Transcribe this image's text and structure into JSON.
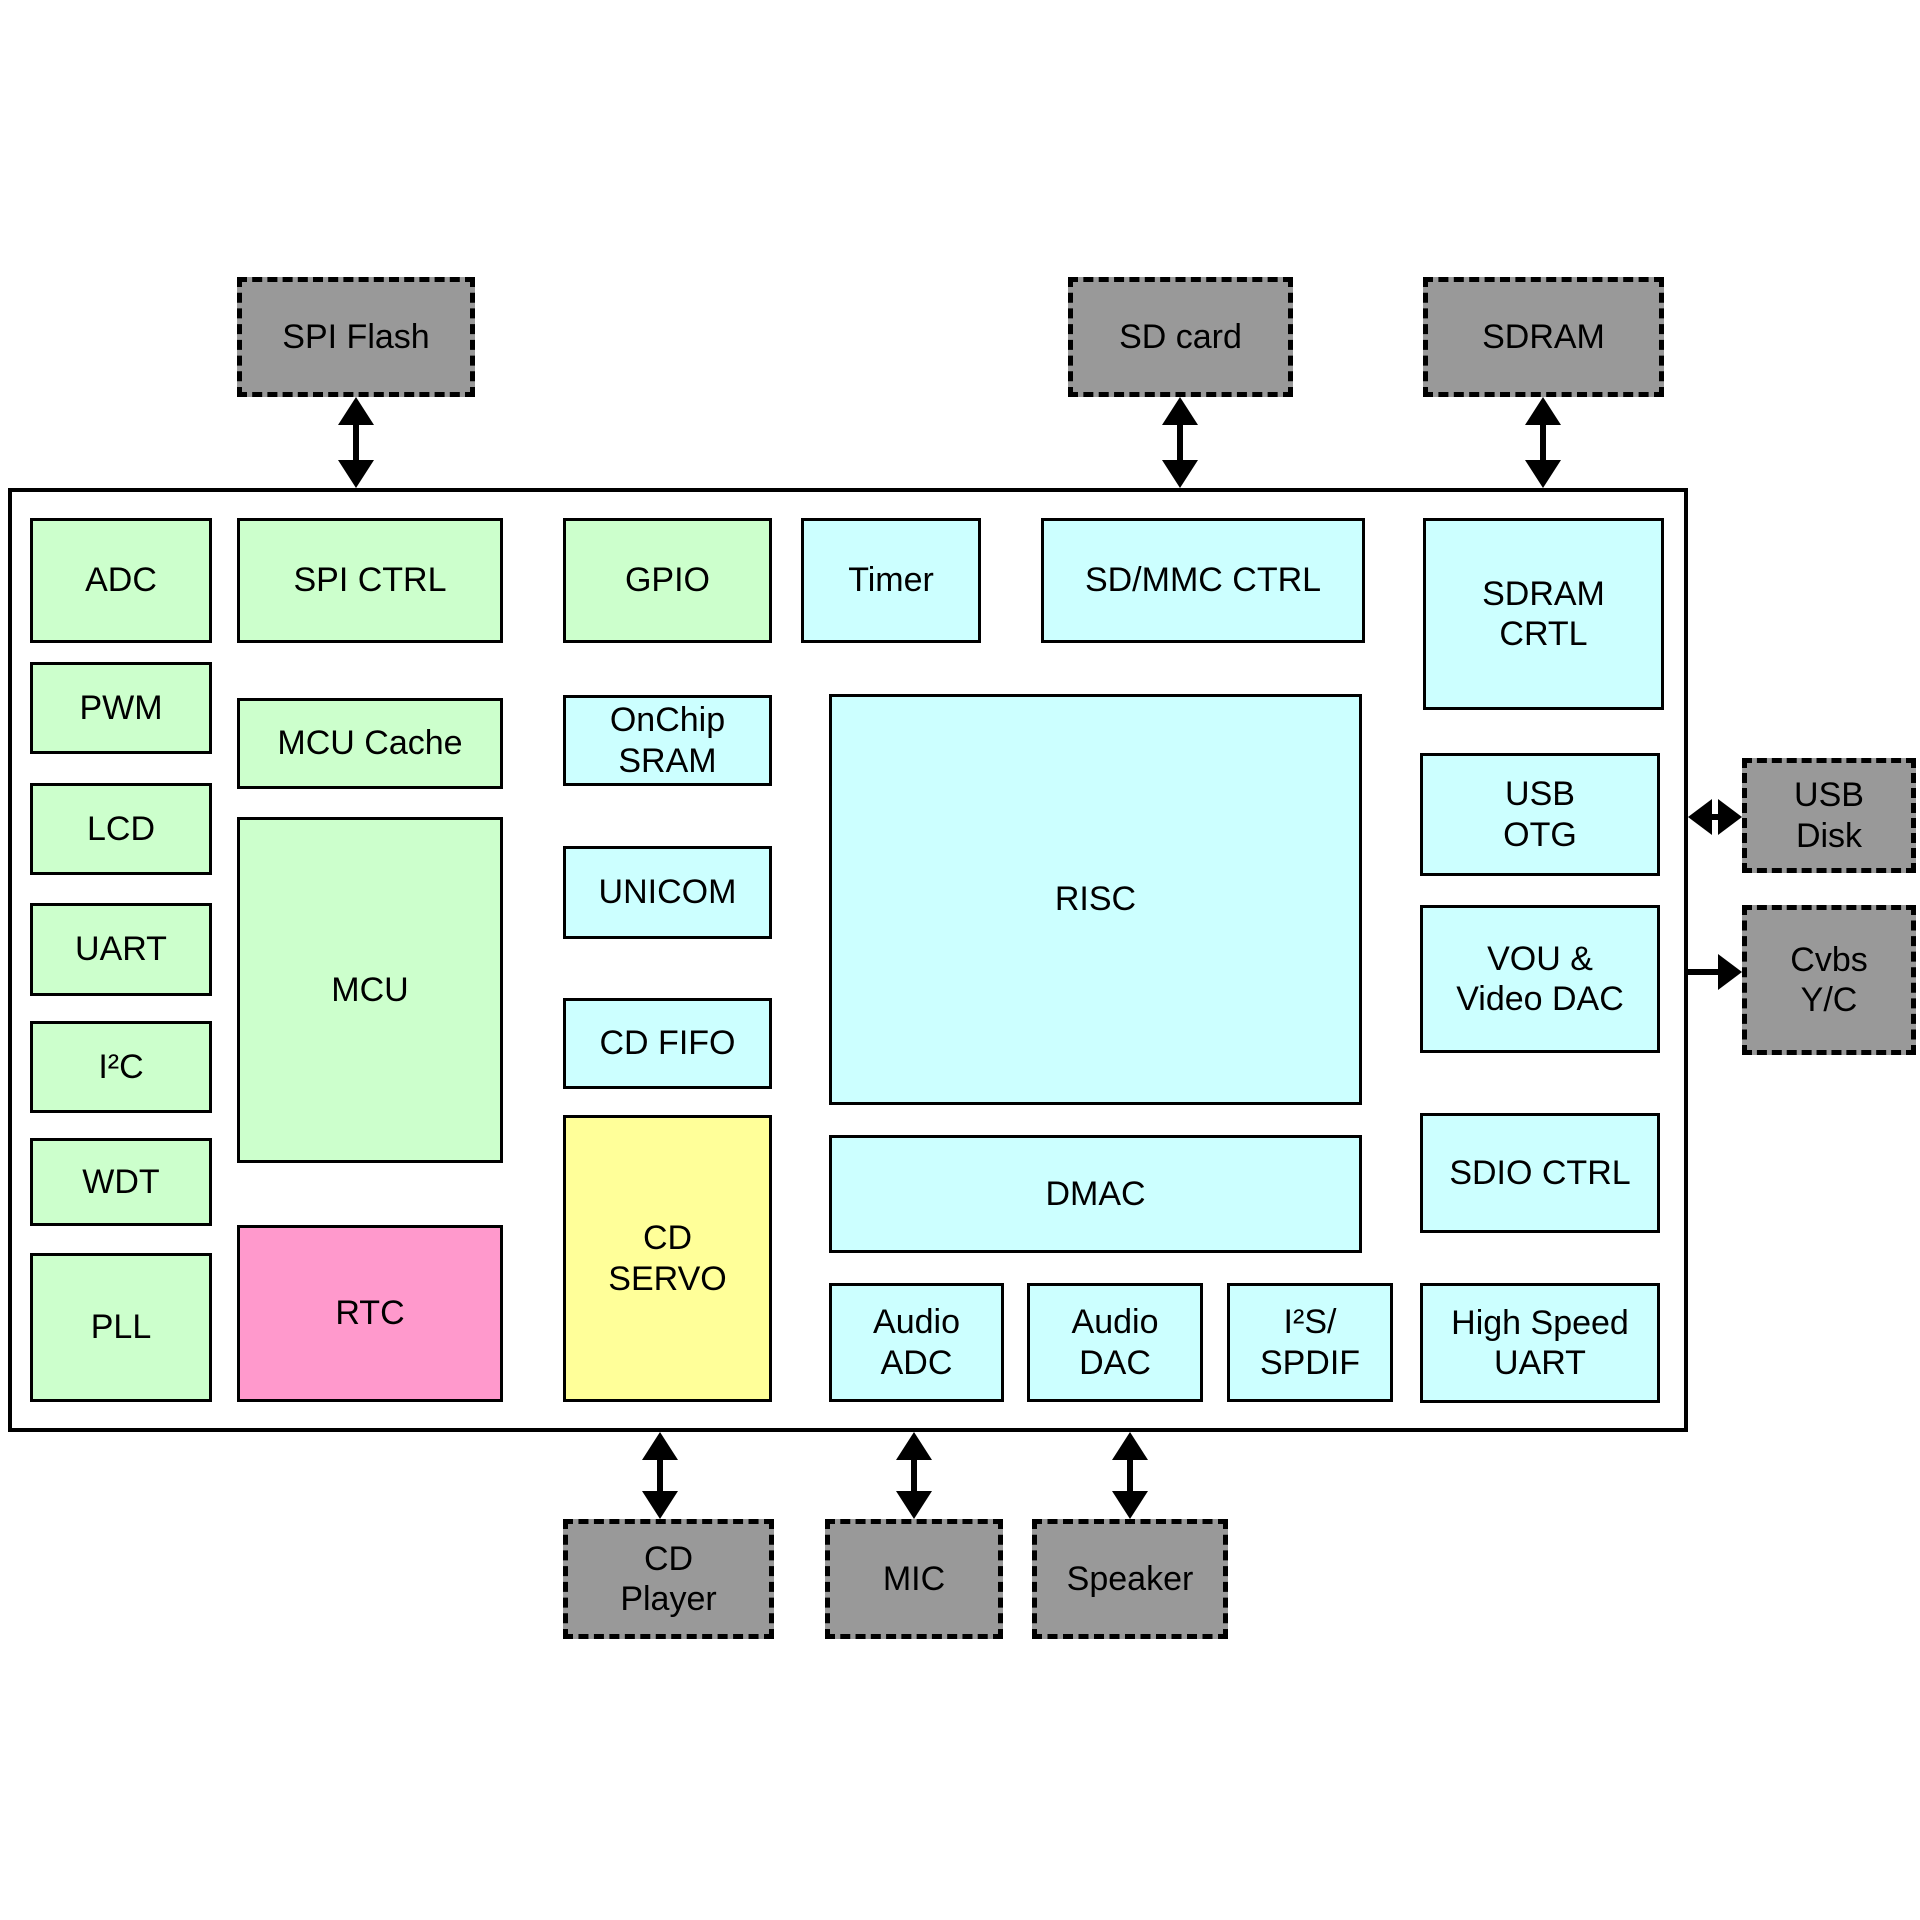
{
  "colors": {
    "block_green": "#CCFFCC",
    "block_cyan": "#CCFFFF",
    "block_yellow": "#FFFF99",
    "block_pink": "#FF99CC",
    "external_gray": "#999999",
    "line_black": "#000000",
    "background": "#FFFFFF"
  },
  "external": {
    "spi_flash": "SPI Flash",
    "sd_card": "SD card",
    "sdram": "SDRAM",
    "usb_disk": "USB\nDisk",
    "cvbs_yc": "Cvbs\nY/C",
    "cd_player": "CD\nPlayer",
    "mic": "MIC",
    "speaker": "Speaker"
  },
  "blocks": {
    "adc": "ADC",
    "spi_ctrl": "SPI CTRL",
    "gpio": "GPIO",
    "timer": "Timer",
    "sd_mmc_ctrl": "SD/MMC CTRL",
    "sdram_crtl": "SDRAM\nCRTL",
    "pwm": "PWM",
    "mcu_cache": "MCU Cache",
    "lcd": "LCD",
    "mcu": "MCU",
    "uart": "UART",
    "i2c": "I²C",
    "wdt": "WDT",
    "pll": "PLL",
    "rtc": "RTC",
    "onchip_sram": "OnChip\nSRAM",
    "unicom": "UNICOM",
    "cd_fifo": "CD FIFO",
    "cd_servo": "CD\nSERVO",
    "risc": "RISC",
    "dmac": "DMAC",
    "audio_adc": "Audio\nADC",
    "audio_dac": "Audio\nDAC",
    "i2s_spdif": "I²S/\nSPDIF",
    "usb_otg": "USB\nOTG",
    "vou_video_dac": "VOU &\nVideo DAC",
    "sdio_ctrl": "SDIO CTRL",
    "high_speed_uart": "High Speed\nUART"
  }
}
